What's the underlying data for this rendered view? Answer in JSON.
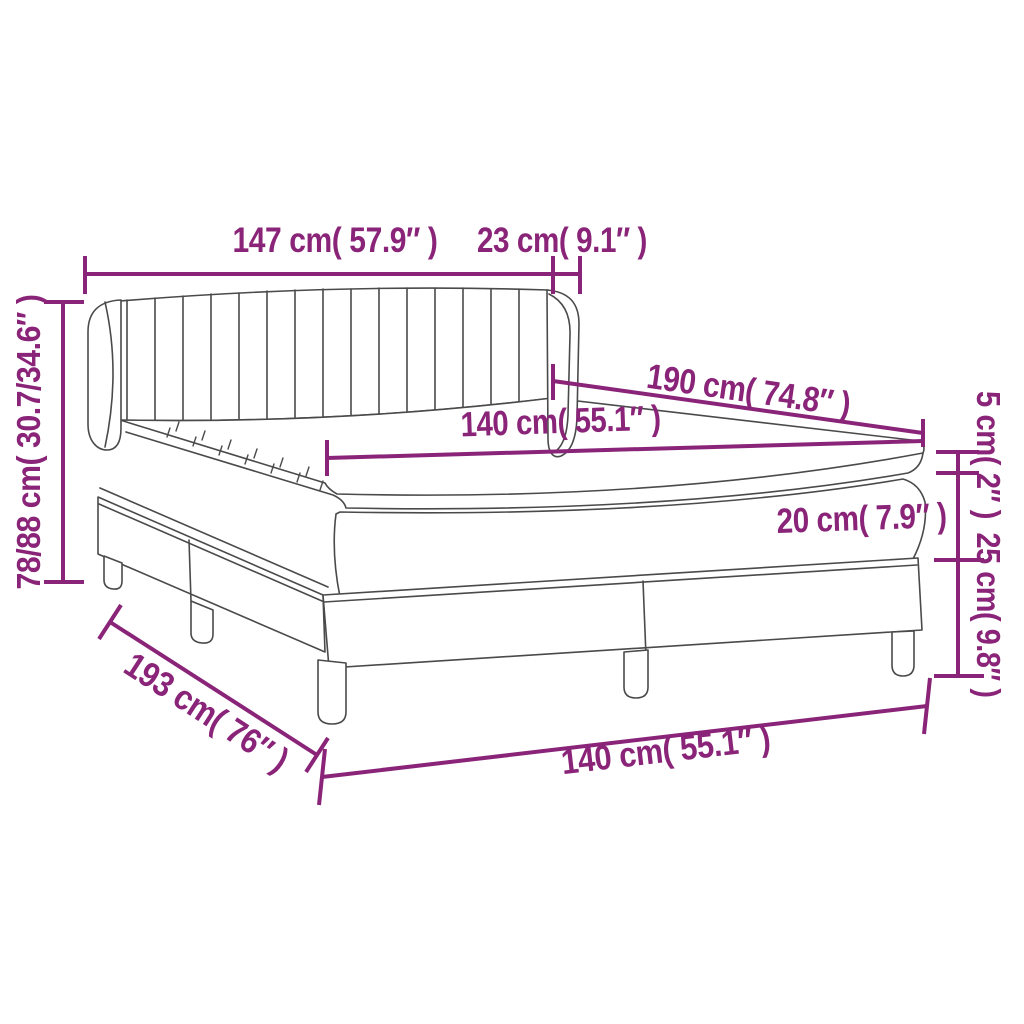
{
  "diagram": {
    "type": "product dimension diagram",
    "subject": "box spring bed with winged fluted headboard, mattress and topper",
    "labels": {
      "headboard_width": "147 cm( 57.9″ )",
      "headboard_side_depth": "23 cm( 9.1″ )",
      "total_height": "78/88 cm( 30.7/34.6″ )",
      "bed_length": "190 cm( 74.8″ )",
      "mattress_width": "140 cm( 55.1″ )",
      "topper_thickness": "5 cm( 2″ )",
      "mattress_thickness": "20 cm( 7.9″ )",
      "base_height": "25 cm( 9.8″ )",
      "base_length": "193 cm( 76″ )",
      "base_width": "140 cm( 55.1″ )"
    },
    "colors": {
      "dimension": "#8a2478",
      "outline": "#4a4a4a",
      "background": "#ffffff"
    }
  }
}
